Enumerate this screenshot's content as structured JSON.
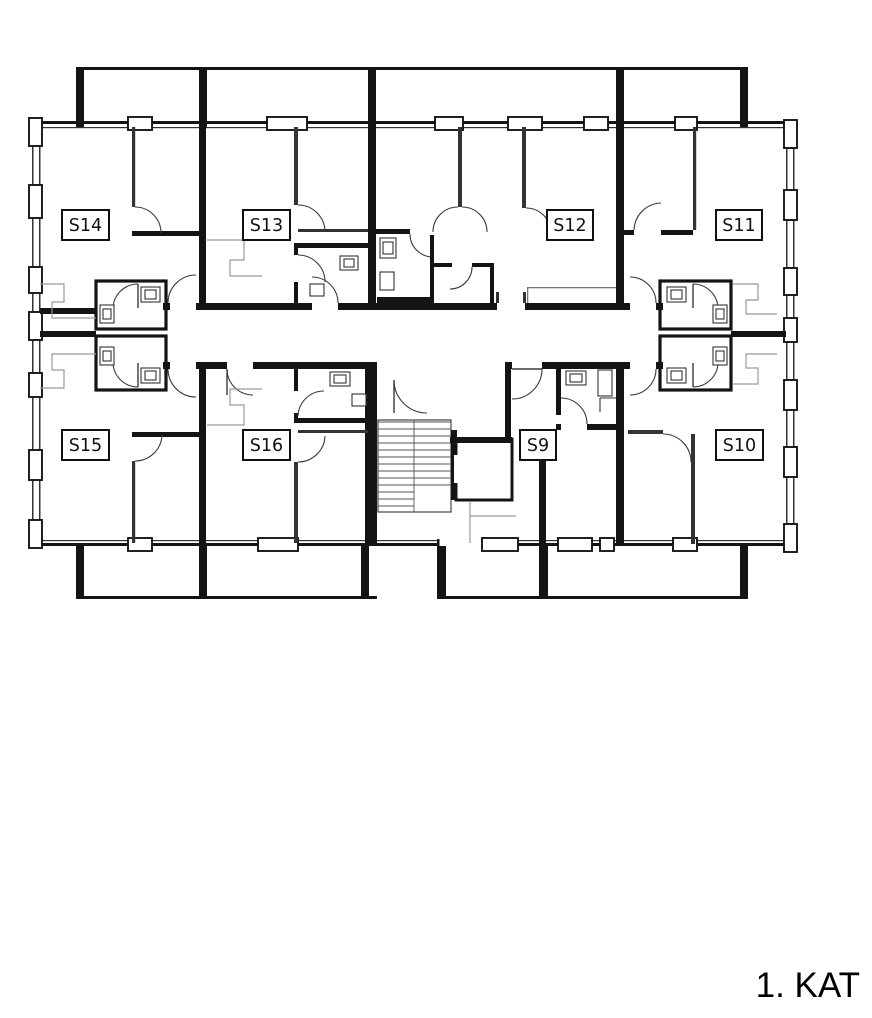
{
  "floor_plan": {
    "floor_label": "1. KAT",
    "rooms": [
      {
        "label": "S14"
      },
      {
        "label": "S13"
      },
      {
        "label": "S12"
      },
      {
        "label": "S11"
      },
      {
        "label": "S15"
      },
      {
        "label": "S16"
      },
      {
        "label": "S9"
      },
      {
        "label": "S10"
      }
    ],
    "colors": {
      "wall": "#141414",
      "thin_wall": "#333333",
      "furniture_gray": "#9a9a9a",
      "background": "#ffffff",
      "label_text": "#111111"
    }
  }
}
